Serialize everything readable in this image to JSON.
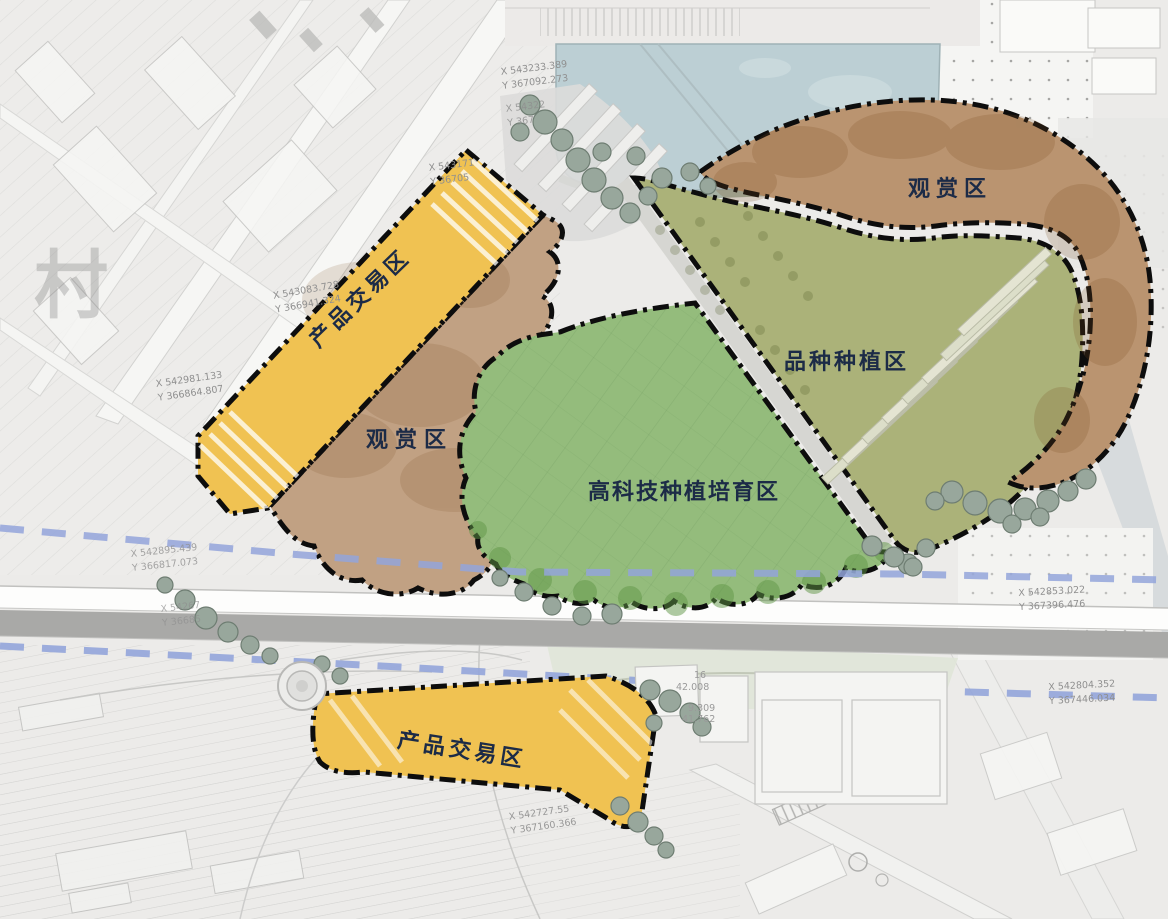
{
  "map": {
    "title": "landscape master plan with functional zones",
    "zones": [
      {
        "key": "product_trading_north",
        "label": "产品交易区",
        "color": "#f0c252"
      },
      {
        "key": "viewing_west",
        "label": "观赏区",
        "color": "#c1a183"
      },
      {
        "key": "hightech_cultivation",
        "label": "高科技种植培育区",
        "color": "#94bc7c"
      },
      {
        "key": "variety_planting",
        "label": "品种种植区",
        "color": "#abb279"
      },
      {
        "key": "viewing_northeast",
        "label": "观赏区",
        "color": "#ba9470"
      },
      {
        "key": "product_trading_south",
        "label": "产品交易区",
        "color": "#f0c252"
      }
    ],
    "coordinates": [
      {
        "x": "X 543233.389",
        "y": "Y 367092.273"
      },
      {
        "x": "X 54322",
        "y": "Y 367"
      },
      {
        "x": "X 543171",
        "y": "Y 36705"
      },
      {
        "x": "X 543083.728",
        "y": "Y 366941.324"
      },
      {
        "x": "X 542981.133",
        "y": "Y 366864.807"
      },
      {
        "x": "X 542895.439",
        "y": "Y 366817.073"
      },
      {
        "x": "X 54267",
        "y": "Y 36685"
      },
      {
        "x": "X 542853.022",
        "y": "Y 367396.476"
      },
      {
        "x": "X 542804.352",
        "y": "Y 367446.034"
      },
      {
        "x": "X 542727.55",
        "y": "Y 367160.366"
      }
    ],
    "survey_numbers": [
      "16",
      "42.008",
      "9.309",
      "41.762"
    ],
    "watermark": "村",
    "colors": {
      "water": "#bccfd4",
      "boundary_dashdot": "#0d0d0d",
      "parcel_dashed_line": "#93a5da",
      "expressway_gray": "#a9a9a7",
      "road_white": "#f7f7f5"
    }
  }
}
